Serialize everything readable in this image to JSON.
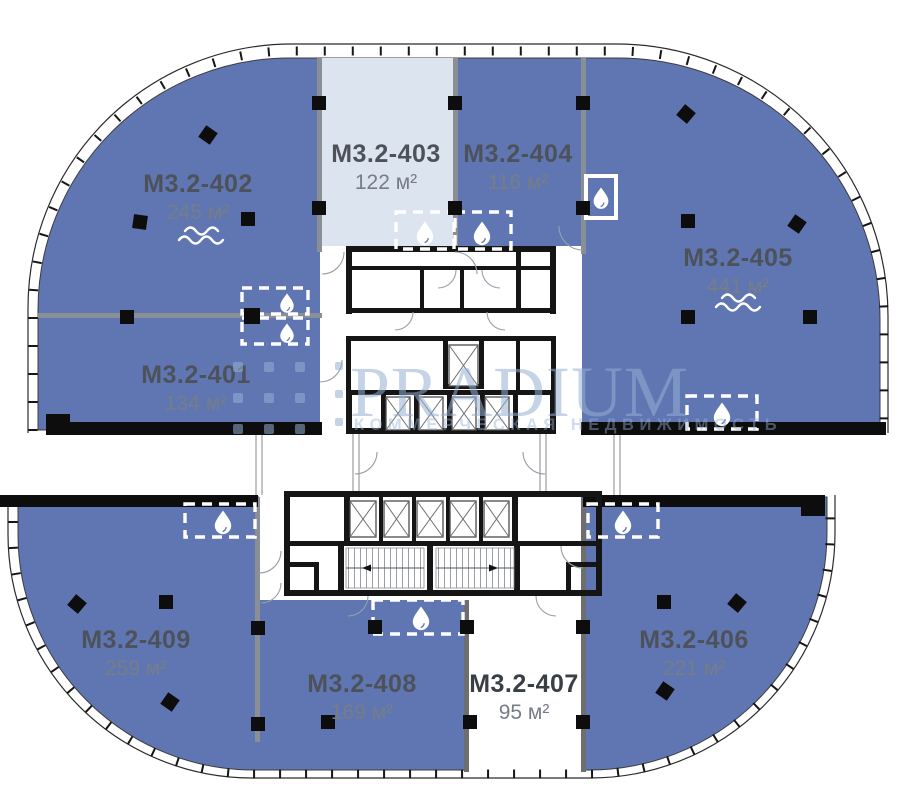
{
  "units": [
    {
      "id": "M3.2-401",
      "area": "134 м²",
      "fill": "blue",
      "icons": []
    },
    {
      "id": "M3.2-402",
      "area": "245 м²",
      "fill": "blue",
      "icons": [
        "water-waves"
      ]
    },
    {
      "id": "M3.2-403",
      "area": "122 м²",
      "fill": "light",
      "icons": []
    },
    {
      "id": "M3.2-404",
      "area": "116 м²",
      "fill": "blue",
      "icons": []
    },
    {
      "id": "M3.2-405",
      "area": "441 м²",
      "fill": "blue",
      "icons": [
        "water-waves"
      ]
    },
    {
      "id": "M3.2-406",
      "area": "221 м²",
      "fill": "blue",
      "icons": []
    },
    {
      "id": "M3.2-407",
      "area": "95 м²",
      "fill": "white",
      "icons": []
    },
    {
      "id": "M3.2-408",
      "area": "169 м²",
      "fill": "blue",
      "icons": []
    },
    {
      "id": "M3.2-409",
      "area": "259 м²",
      "fill": "blue",
      "icons": []
    }
  ],
  "watermark": {
    "brand": "PRADIUM",
    "tagline": "КОММЕРЧЕСКАЯ НЕДВИЖИМОСТЬ"
  },
  "icons": {
    "water_drop": "💧",
    "water_waves": "≈",
    "column": "■"
  },
  "colors": {
    "background": "#ffffff",
    "unit_blue": "#6076b3",
    "unit_light": "#dce4f0",
    "unit_white": "#ffffff",
    "wall_black": "#111111",
    "partition_gray": "#8a8f96",
    "unit_name_text": "#4d525a",
    "unit_area_text": "#777d86",
    "watermark_blue": "#96afd2"
  }
}
